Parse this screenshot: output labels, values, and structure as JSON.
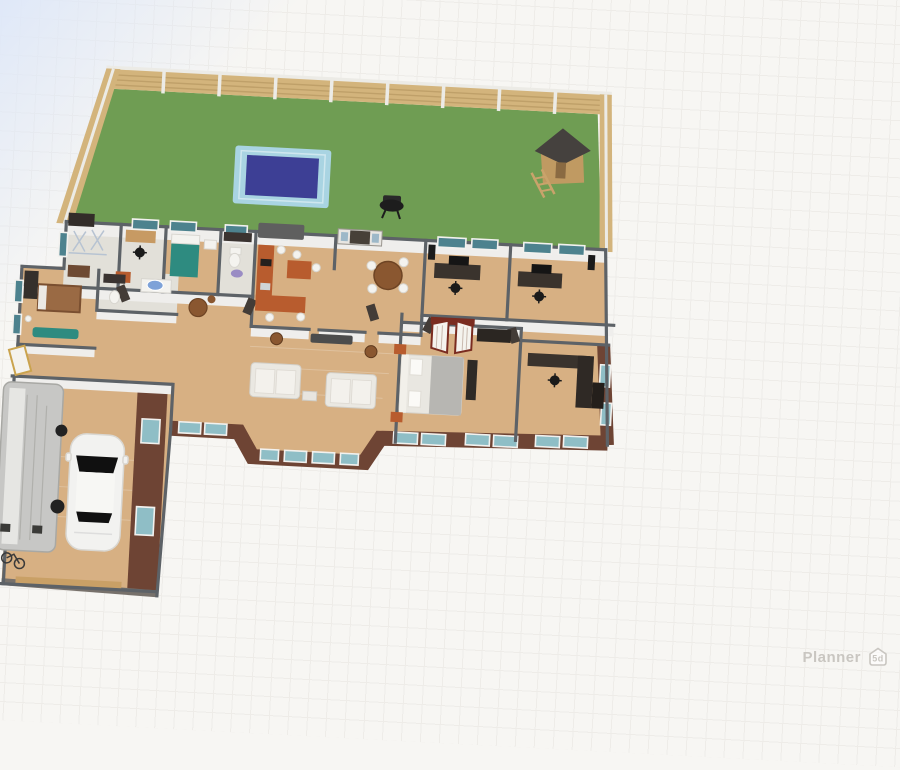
{
  "app": {
    "watermark_text": "Planner",
    "watermark_badge": "5d"
  },
  "colors": {
    "bg": "#f7f6f3",
    "grid": "#e7e4e0",
    "sky": "#dfe8f8",
    "grass": "#6f9d53",
    "pool_deck": "#a9d4e2",
    "pool_water": "#3d3f95",
    "fence_wood": "#d3b47c",
    "fence_slat": "#bfa069",
    "fence_post": "#ecebe6",
    "floor_wood": "#d7b083",
    "floor_light": "#e2e0d9",
    "wall_top": "#5d6267",
    "wall_face": "#efeeec",
    "brick": "#6e4434",
    "window_glass": "#4d828e",
    "window_glass_light": "#8fbec6",
    "window_frame": "#f2f1ee",
    "cabinet": "#b85c2e",
    "sofa": "#eae8e2",
    "bed_teal": "#2e8b80",
    "table_wood": "#8a5730",
    "dark_furniture": "#3a332d",
    "car_body": "#f2f2f0",
    "vehicle_gray": "#c7c7c5",
    "watermark": "#c9c6c1"
  },
  "scene": {
    "view": "3D floor plan top view",
    "outdoor_objects": [
      "lawn",
      "wooden-fence",
      "swimming-pool",
      "bbq-grill",
      "playhouse"
    ],
    "indoor_objects": [
      "kitchen-cabinets",
      "fridge",
      "dining-table",
      "living-sofas",
      "media-console",
      "master-bed",
      "open-wardrobe",
      "office-desk-a",
      "office-desk-b",
      "teal-bed",
      "bathrooms",
      "round-table",
      "west-bed"
    ],
    "garage_objects": [
      "white-car",
      "rv-camper",
      "bicycles"
    ]
  }
}
